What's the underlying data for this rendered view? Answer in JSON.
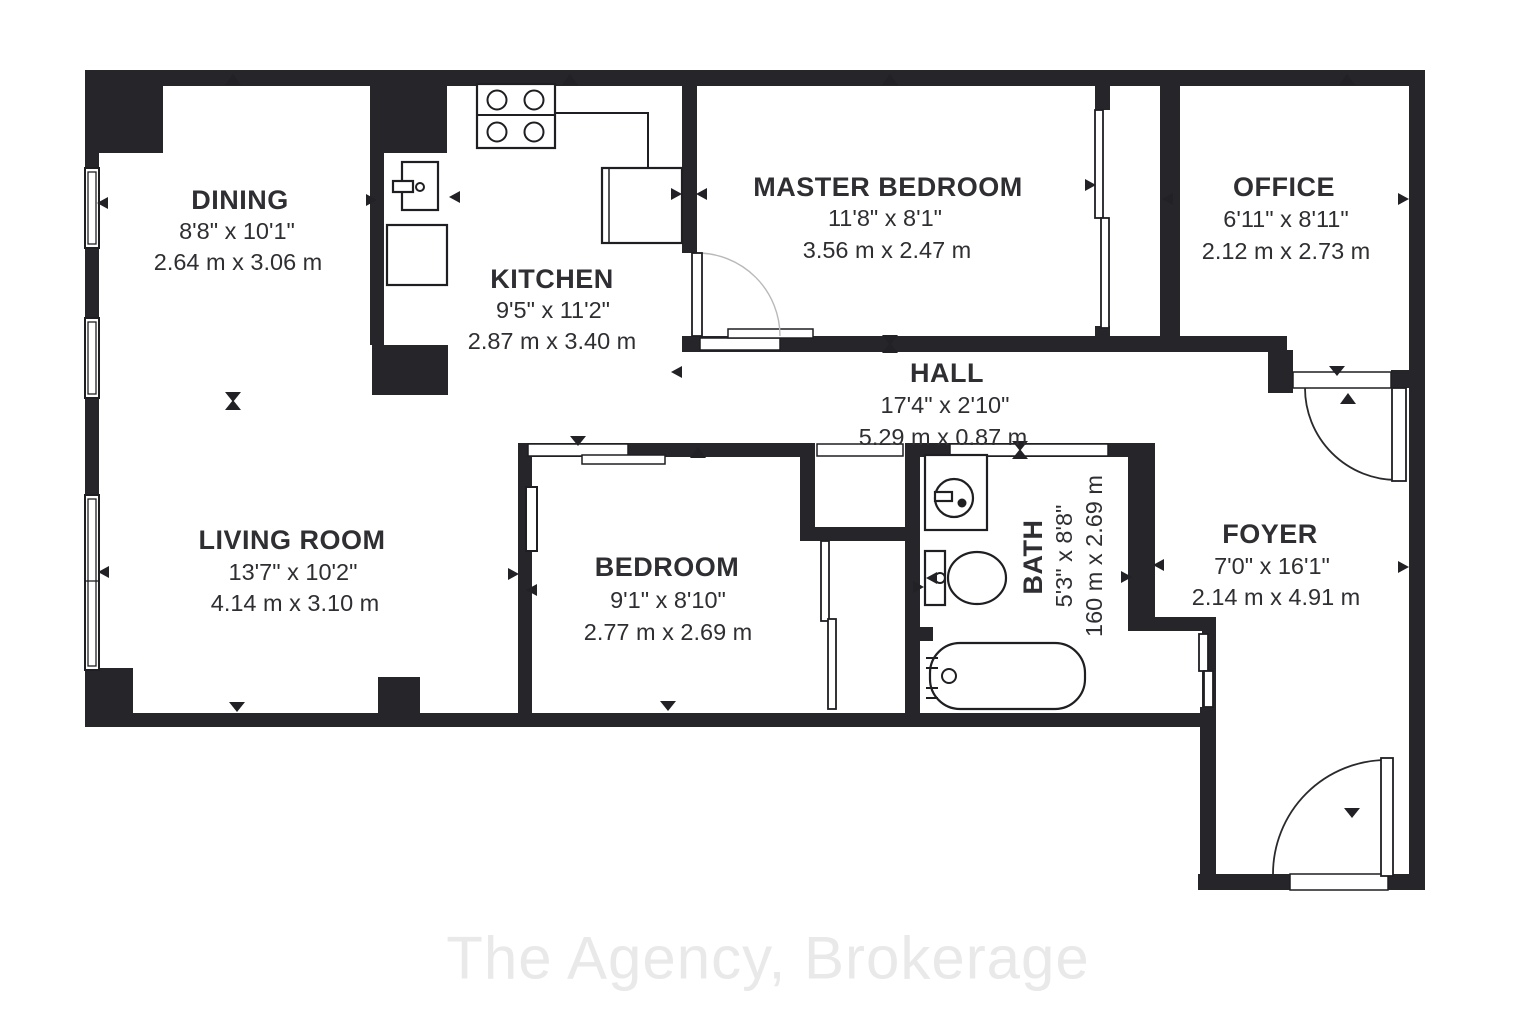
{
  "watermark": "The Agency, Brokerage",
  "rooms": {
    "dining": {
      "name": "DINING",
      "imperial": "8'8\" x 10'1\"",
      "metric": "2.64 m x 3.06 m"
    },
    "kitchen": {
      "name": "KITCHEN",
      "imperial": "9'5\" x 11'2\"",
      "metric": "2.87 m x 3.40 m"
    },
    "master": {
      "name": "MASTER BEDROOM",
      "imperial": "11'8\" x 8'1\"",
      "metric": "3.56 m x 2.47 m"
    },
    "office": {
      "name": "OFFICE",
      "imperial": "6'11\" x 8'11\"",
      "metric": "2.12 m x 2.73 m"
    },
    "hall": {
      "name": "HALL",
      "imperial": "17'4\" x 2'10\"",
      "metric": "5.29 m x 0.87 m"
    },
    "living": {
      "name": "LIVING ROOM",
      "imperial": "13'7\" x 10'2\"",
      "metric": "4.14 m x 3.10 m"
    },
    "bedroom": {
      "name": "BEDROOM",
      "imperial": "9'1\" x 8'10\"",
      "metric": "2.77 m x 2.69 m"
    },
    "bath": {
      "name": "BATH",
      "imperial": "5'3\" x 8'8\"",
      "metric": "160 m x 2.69 m"
    },
    "foyer": {
      "name": "FOYER",
      "imperial": "7'0\" x 16'1\"",
      "metric": "2.14 m x 4.91 m"
    }
  }
}
